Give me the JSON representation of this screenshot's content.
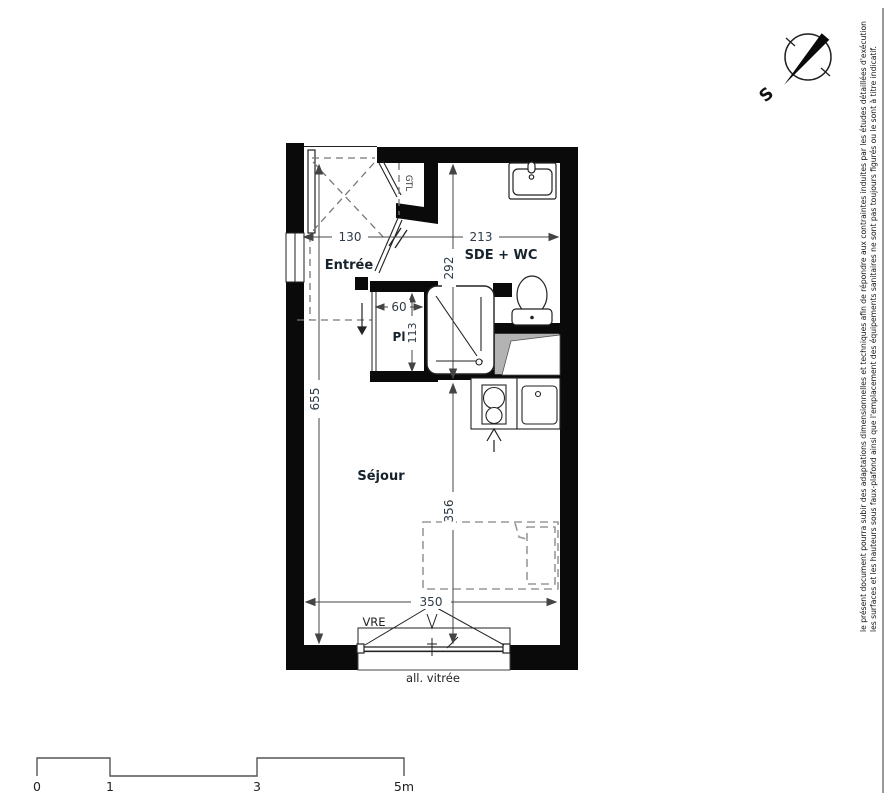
{
  "plan": {
    "rooms": {
      "entree": "Entrée",
      "sde_wc": "SDE + WC",
      "sejour": "Séjour",
      "placard": "Pl",
      "gtl": "GTL"
    },
    "dimensions": {
      "entree_width": "130",
      "sde_width": "213",
      "sde_height": "292",
      "placard_width": "60",
      "placard_height": "113",
      "sejour_height": "655",
      "sejour_lower_height": "356",
      "window_width": "350"
    },
    "window": {
      "shutter_label": "VRE",
      "glazing_label": "all. vitrée"
    }
  },
  "compass": {
    "south_label": "S"
  },
  "scale_bar": {
    "ticks": [
      "0",
      "1",
      "3",
      "5m"
    ]
  },
  "disclaimer": {
    "line1": "le présent document pourra subir des adaptations dimensionnelles et techniques afin de répondre aux contraintes induites par les études détaillées d'exécution",
    "line2": "les surfaces et les hauteurs sous faux-plafond ainsi que l'emplacement des équipements sanitaires ne sont pas toujours figurés ou le sont à titre indicatif."
  },
  "colors": {
    "wall": "#0a0a0a",
    "line": "#222222",
    "dashed": "#777777",
    "bed": "#999999",
    "duct_fill": "#b3b3b3"
  }
}
